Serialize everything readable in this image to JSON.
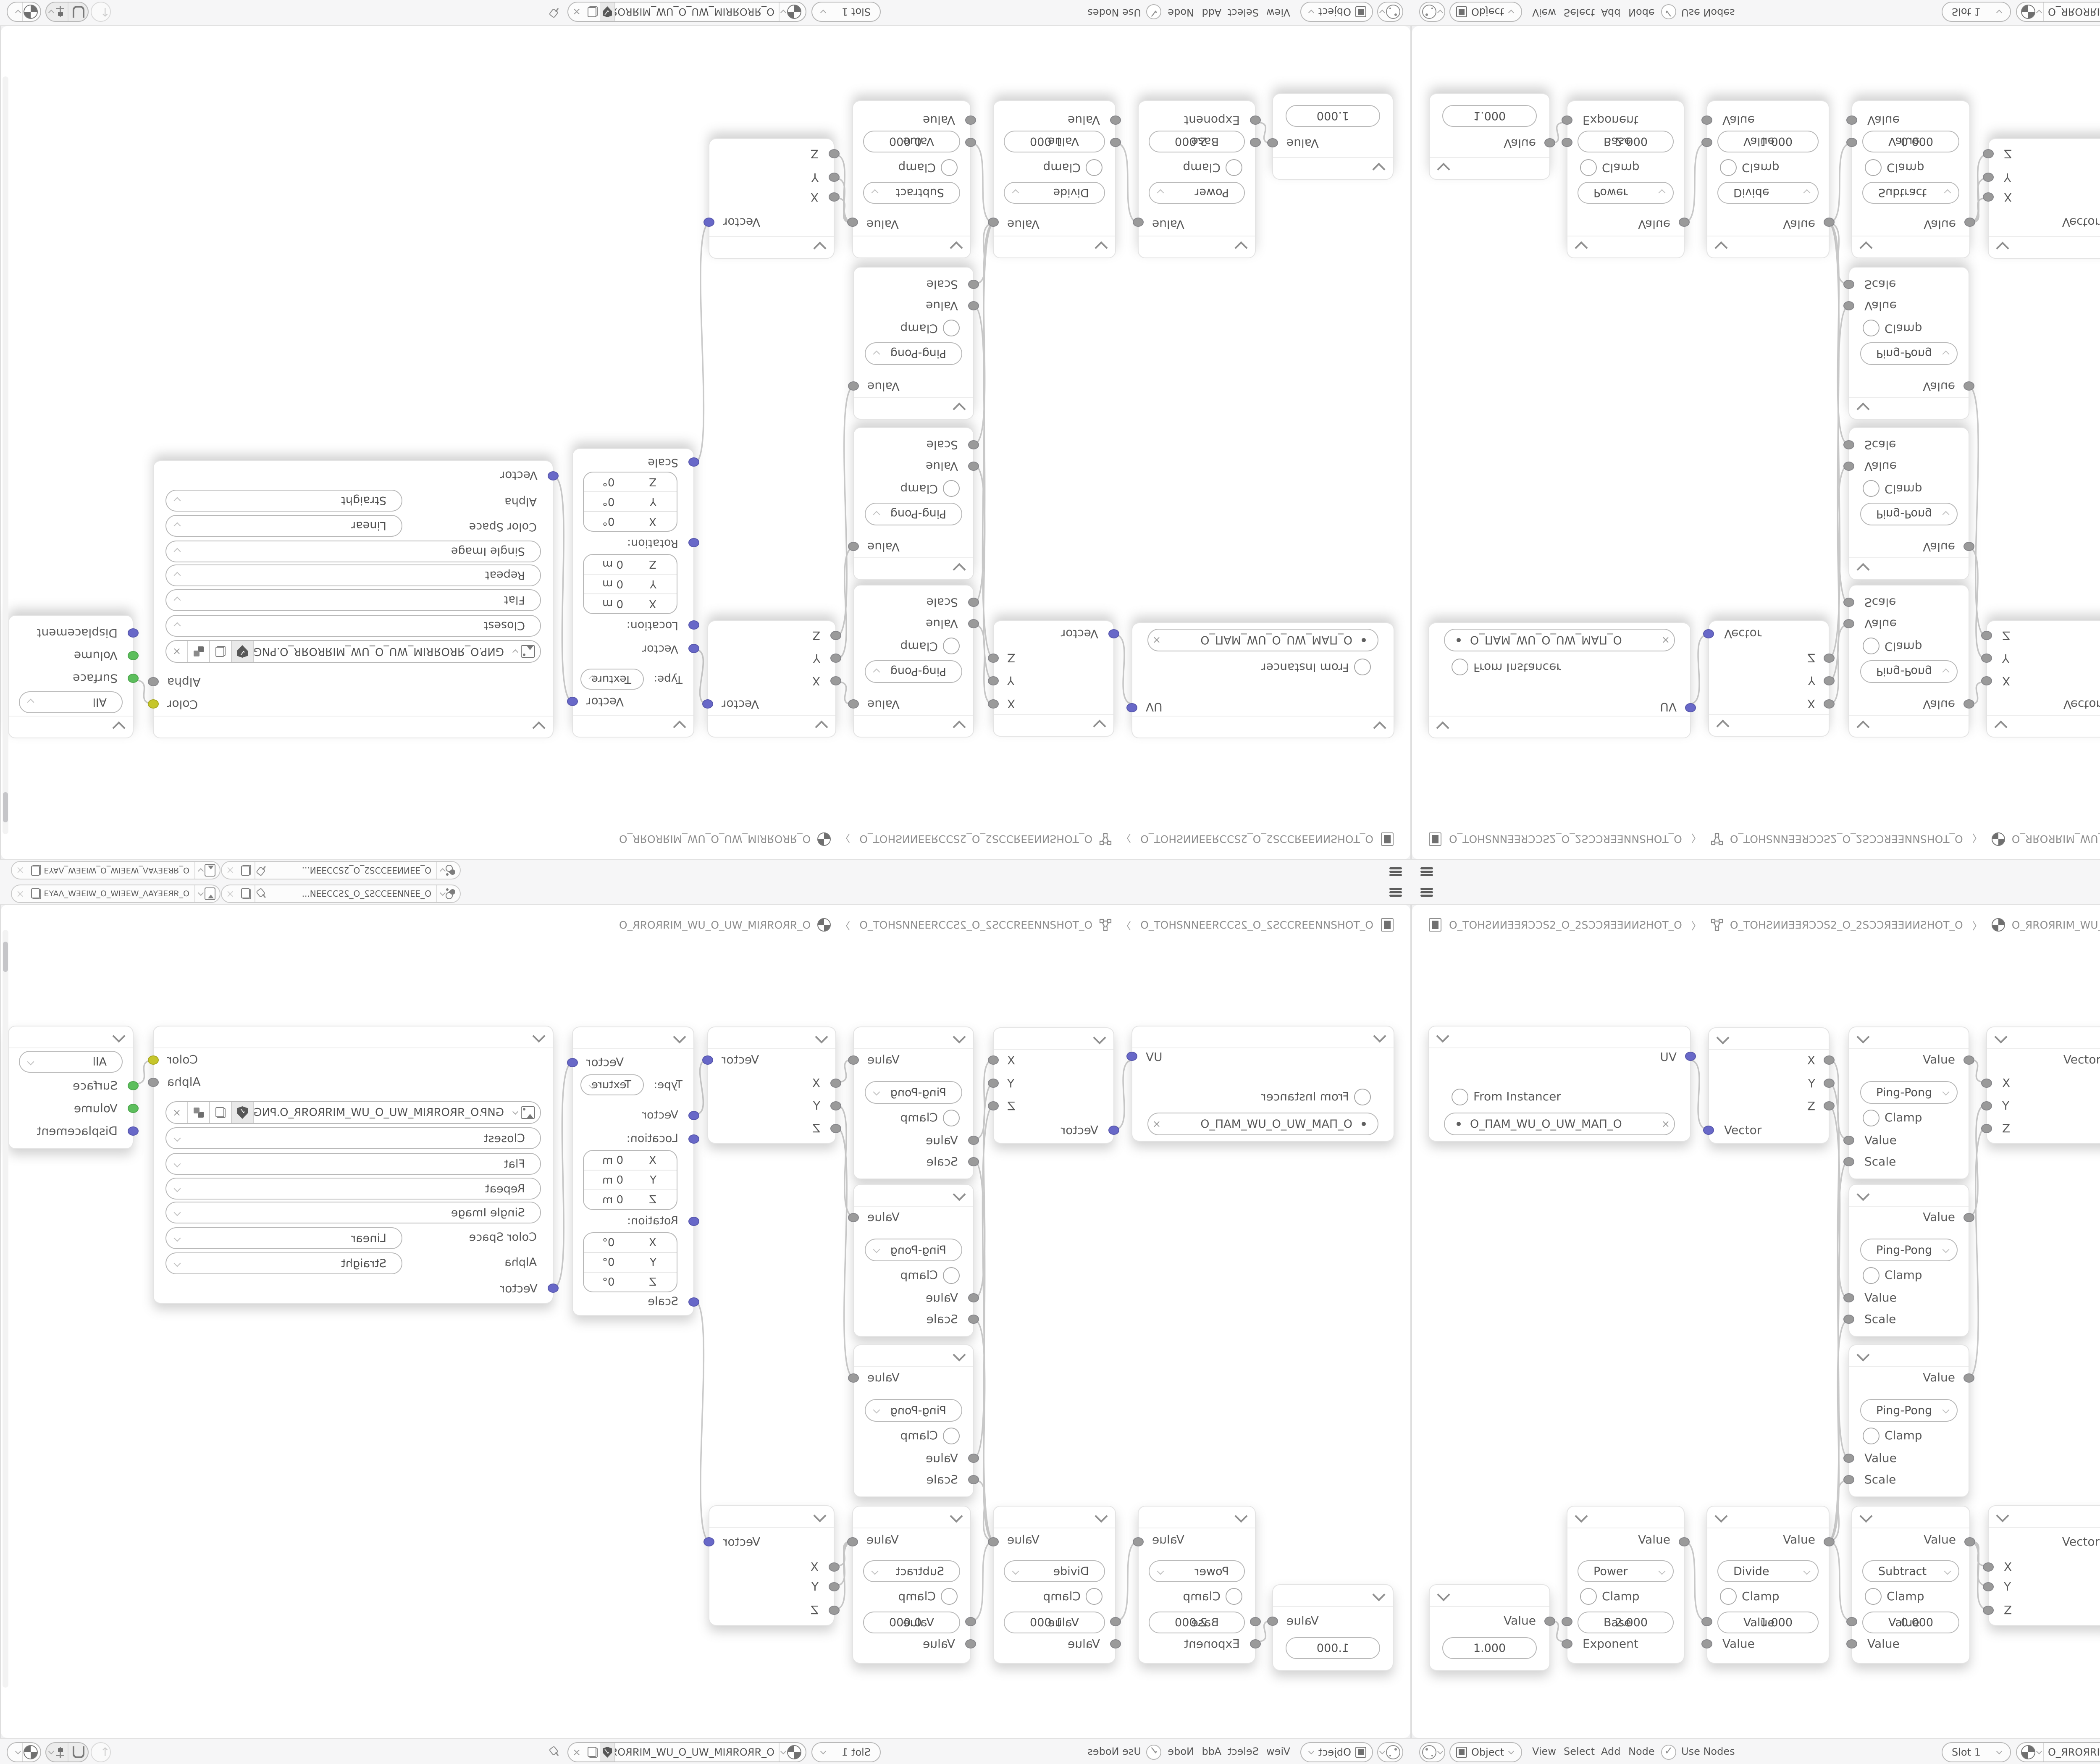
{
  "topbar": {
    "scene_selector": {
      "icon": "scene-icon",
      "value": "O_ƎƎИИƎƎƆƆS2_O_2SƆƆƎƎИ..."
    },
    "view_layer_selector": {
      "icon": "view-layer-icon",
      "value": "O_ЯRƎEYAΛ_WƎEIW_O_WIƎEW_ΛAYƎERЯ_O"
    }
  },
  "breadcrumb": {
    "scene": "O_TOHƧИИƎƎЯƆƆS2_O_2SƆƆЯƎƎИИƧHOT_O",
    "object": "O_TOHƧИИƎƎЯƆƆS2_O_2SƆƆЯƎƎИИƧHOT_O",
    "material": "O_ЯROЯRIM_WU_O_UW_MIЯROЯR_O"
  },
  "nodes": {
    "uv_map": {
      "output": "UV",
      "from_instancer": "From Instancer",
      "uv_map_name": "O_ПAM_WU_O_UW_MAП_O"
    },
    "separate_xyz": {
      "x": "X",
      "y": "Y",
      "z": "Z",
      "vector": "Vector"
    },
    "math_pingpong": {
      "output": "Value",
      "operation": "Ping-Pong",
      "clamp_label": "Clamp",
      "value_label": "Value",
      "scale_label": "Scale"
    },
    "combine_xyz": {
      "x": "X",
      "y": "Y",
      "z": "Z",
      "vector": "Vector"
    },
    "mapping": {
      "output": "Vector",
      "type_label": "Type:",
      "type_value": "Texture",
      "vector_input": "Vector",
      "location_label": "Location:",
      "location_rows": [
        {
          "axis": "X",
          "value": "0 m"
        },
        {
          "axis": "Y",
          "value": "0 m"
        },
        {
          "axis": "Z",
          "value": "0 m"
        }
      ],
      "rotation_label": "Rotation:",
      "rotation_rows": [
        {
          "axis": "X",
          "value": "0°"
        },
        {
          "axis": "Y",
          "value": "0°"
        },
        {
          "axis": "Z",
          "value": "0°"
        }
      ],
      "scale_label": "Scale"
    },
    "image_texture": {
      "color_output": "Color",
      "alpha_output": "Alpha",
      "image_name": "GИP.O_ЯROЯRIM_WU_O_UW_MIЯROЯR_O.PNG",
      "interpolation": "Closest",
      "projection": "Flat",
      "extension": "Repeat",
      "source": "Single Image",
      "color_space_label": "Color Space",
      "color_space": "Linear",
      "alpha_label": "Alpha",
      "alpha_mode": "Straight",
      "vector_input": "Vector"
    },
    "material_output": {
      "target": "All",
      "surface": "Surface",
      "volume": "Volume",
      "displacement": "Displacement"
    },
    "value_node": {
      "output": "Value",
      "value": "1.000"
    },
    "math_power": {
      "output": "Value",
      "operation": "Power",
      "clamp_label": "Clamp",
      "base_label": "Base",
      "base_value": "2.000",
      "exponent_label": "Exponent"
    },
    "math_divide": {
      "output": "Value",
      "operation": "Divide",
      "clamp_label": "Clamp",
      "value_label": "Value",
      "value": "1.000",
      "input_label": "Value"
    },
    "math_subtract": {
      "output": "Value",
      "operation": "Subtract",
      "clamp_label": "Clamp",
      "value_label": "Value",
      "value": "0.000",
      "input_label": "Value"
    }
  },
  "bottombar": {
    "shader_type": "Object",
    "menus": {
      "view": "View",
      "select": "Select",
      "add": "Add",
      "node": "Node"
    },
    "use_nodes": "Use Nodes",
    "slot": "Slot 1",
    "material_name": "O_ЯROЯRIM_WU_O_UW_MIЯROЯR_O"
  }
}
